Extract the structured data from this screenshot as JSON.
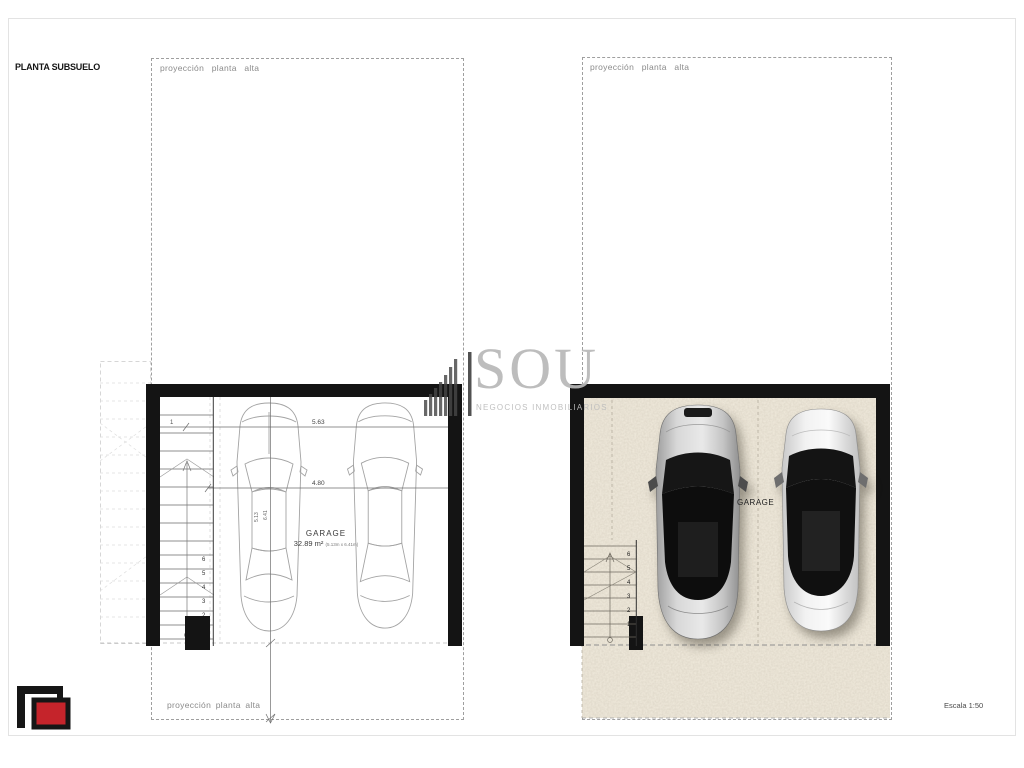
{
  "page": {
    "title": "PLANTA SUBSUELO",
    "scale_label": "Escala 1:50"
  },
  "watermark": {
    "brand": "SOU",
    "subtitle": "NEGOCIOS INMOBILIARIOS"
  },
  "left_plan": {
    "projection_label_top": "proyección planta alta",
    "projection_label_bottom": "proyección planta alta",
    "garage_label": "GARAGE",
    "garage_area": "32.89 m²",
    "garage_area_detail": "(5.13m x 6.41m)",
    "dim_width_top": "5.63",
    "dim_width_inner": "4.80",
    "dim_left_mark": "1",
    "dim_depth_a": "5.13",
    "dim_depth_b": "6.41",
    "stair_numbers": [
      "6",
      "5",
      "4",
      "3",
      "2",
      "1"
    ]
  },
  "right_plan": {
    "projection_label_top": "proyección planta alta",
    "garage_label": "GARAGE",
    "stair_numbers": [
      "6",
      "5",
      "4",
      "3",
      "2",
      "1"
    ]
  },
  "colors": {
    "wall": "#141414",
    "logo_red": "#c5242b",
    "floor_base": "#f1ebdd",
    "watermark_gray": "#b8b8b8"
  }
}
